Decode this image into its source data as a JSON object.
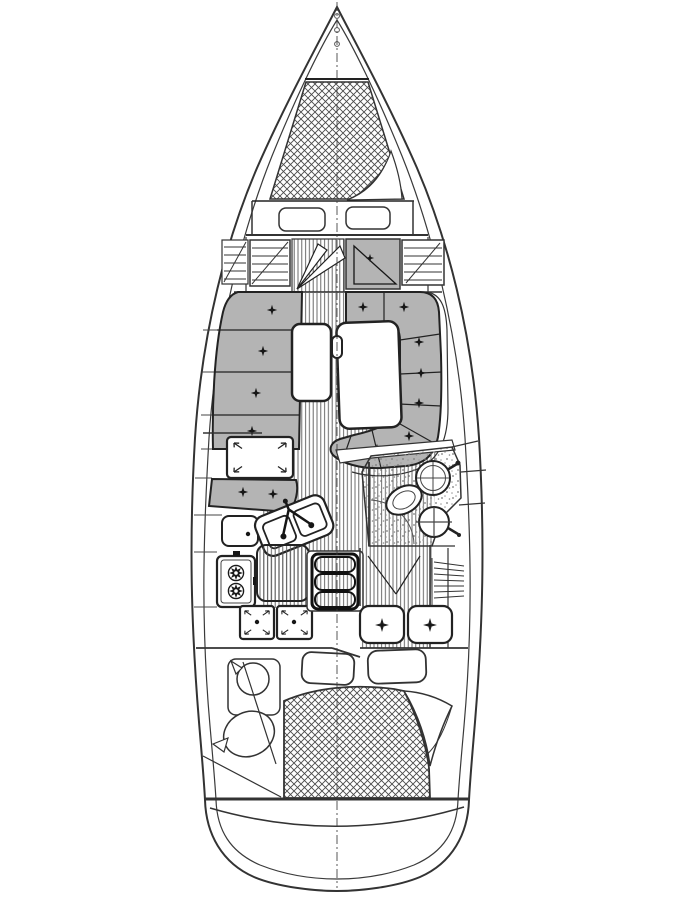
{
  "meta": {
    "type": "boat-interior-floor-plan"
  },
  "colors": {
    "background": "#ffffff",
    "line": "#2b2b2b",
    "line_dark": "#161616",
    "cushion": "#b4b4b4",
    "hatch_line": "#4a4a4a",
    "floor_line": "#5a5a5a",
    "stipple_dot": "#7a7a7a"
  },
  "features": [
    "bow-pulpit",
    "v-berth-mattress",
    "berth-fold-corner",
    "forward-cushions",
    "hanging-locker-port",
    "forward-cabin-door",
    "forward-door-panel",
    "hanging-locker-starboard",
    "salon-floor",
    "port-settee",
    "starboard-u-settee",
    "salon-table",
    "mast-post",
    "nav-chart-table",
    "galley-seat",
    "galley-double-sink",
    "galley-stove",
    "icebox-lids",
    "companionway-steps",
    "head-floor",
    "head-sink",
    "toilet",
    "head-basin",
    "aft-cabin-door",
    "aft-louver-locker",
    "aft-seats",
    "aft-berth",
    "pillows",
    "fender-locker",
    "transom",
    "centerline"
  ]
}
